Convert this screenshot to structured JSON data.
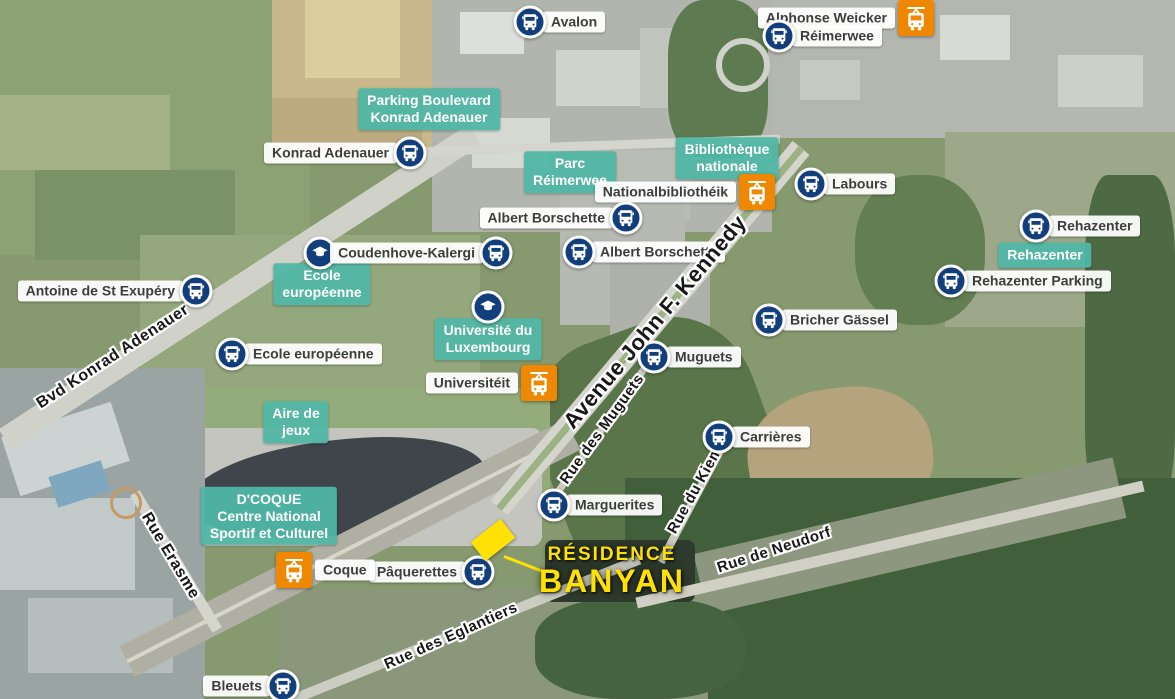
{
  "colors": {
    "bus_blue": "#123f7c",
    "tram_orange": "#ef8800",
    "area_teal": "#50b7a6",
    "stop_label_bg": "#ffffff",
    "stop_label_text": "#3d3d3d",
    "street_text": "#171717",
    "residence_yellow": "#ffe103"
  },
  "markers": [
    {
      "id": "avalon",
      "type": "bus",
      "label": "Avalon",
      "side": "right",
      "x": 530,
      "y": 22
    },
    {
      "id": "alphonse-weicker",
      "type": "tram",
      "label": "Alphonse Weicker",
      "side": "left",
      "x": 916,
      "y": 18
    },
    {
      "id": "reimerwee",
      "type": "bus",
      "label": "Réimerwee",
      "side": "right",
      "x": 779,
      "y": 36
    },
    {
      "id": "konrad-adenauer",
      "type": "bus",
      "label": "Konrad Adenauer",
      "side": "left",
      "x": 410,
      "y": 153
    },
    {
      "id": "nationalbibliotheik",
      "type": "tram",
      "label": "Nationalbibliothéik",
      "side": "left",
      "x": 757,
      "y": 192
    },
    {
      "id": "labours",
      "type": "bus",
      "label": "Labours",
      "side": "right",
      "x": 811,
      "y": 184
    },
    {
      "id": "albert-borschette-1",
      "type": "bus",
      "label": "Albert Borschette",
      "side": "left",
      "x": 626,
      "y": 218
    },
    {
      "id": "albert-borschette-2",
      "type": "bus",
      "label": "Albert Borschette",
      "side": "right",
      "x": 579,
      "y": 252
    },
    {
      "id": "rehazenter",
      "type": "bus",
      "label": "Rehazenter",
      "side": "right",
      "x": 1036,
      "y": 226
    },
    {
      "id": "rehazenter-parking",
      "type": "bus",
      "label": "Rehazenter Parking",
      "side": "right",
      "x": 951,
      "y": 281
    },
    {
      "id": "antoine-de-st-exupery",
      "type": "bus",
      "label": "Antoine de St Exupéry",
      "side": "left",
      "x": 196,
      "y": 291
    },
    {
      "id": "ecole-europeenne-school",
      "type": "school",
      "label": "",
      "side": "none",
      "x": 320,
      "y": 253
    },
    {
      "id": "coudenhove-kalergi",
      "type": "bus",
      "label": "Coudenhove-Kalergi",
      "side": "left",
      "x": 496,
      "y": 253
    },
    {
      "id": "universite-school",
      "type": "school",
      "label": "",
      "side": "none",
      "x": 488,
      "y": 307
    },
    {
      "id": "ecole-europeenne",
      "type": "bus",
      "label": "Ecole européenne",
      "side": "right",
      "x": 232,
      "y": 354
    },
    {
      "id": "bricher-gassel",
      "type": "bus",
      "label": "Bricher Gässel",
      "side": "right",
      "x": 769,
      "y": 320
    },
    {
      "id": "muguets",
      "type": "bus",
      "label": "Muguets",
      "side": "right",
      "x": 654,
      "y": 357
    },
    {
      "id": "universiteit",
      "type": "tram",
      "label": "Universitéit",
      "side": "left",
      "x": 539,
      "y": 383
    },
    {
      "id": "carrieres",
      "type": "bus",
      "label": "Carrières",
      "side": "right",
      "x": 719,
      "y": 437
    },
    {
      "id": "marguerites",
      "type": "bus",
      "label": "Marguerites",
      "side": "right",
      "x": 554,
      "y": 505
    },
    {
      "id": "paquerettes",
      "type": "bus",
      "label": "Pâquerettes",
      "side": "left",
      "x": 478,
      "y": 572
    },
    {
      "id": "coque",
      "type": "tram",
      "label": "Coque",
      "side": "right",
      "x": 294,
      "y": 570
    },
    {
      "id": "bleuets",
      "type": "bus",
      "label": "Bleuets",
      "side": "left",
      "x": 283,
      "y": 686
    }
  ],
  "area_labels": [
    {
      "id": "parking-boulevard-konrad-adenauer",
      "lines": [
        "Parking Boulevard",
        "Konrad Adenauer"
      ],
      "x": 429,
      "y": 109
    },
    {
      "id": "parc-reimerwee",
      "lines": [
        "Parc",
        "Réimerwee"
      ],
      "x": 570,
      "y": 172
    },
    {
      "id": "bibliotheque-nationale",
      "lines": [
        "Bibliothèque",
        "nationale"
      ],
      "x": 727,
      "y": 158
    },
    {
      "id": "rehazenter-area",
      "lines": [
        "Rehazenter"
      ],
      "x": 1045,
      "y": 255
    },
    {
      "id": "ecole-europeenne-area",
      "lines": [
        "Ecole",
        "européenne"
      ],
      "x": 322,
      "y": 284
    },
    {
      "id": "universite-du-luxembourg",
      "lines": [
        "Université du",
        "Luxembourg"
      ],
      "x": 488,
      "y": 339
    },
    {
      "id": "aire-de-jeux",
      "lines": [
        "Aire de",
        "jeux"
      ],
      "x": 296,
      "y": 422
    },
    {
      "id": "dcoque",
      "lines": [
        "D'COQUE",
        "Centre National",
        "Sportif et Culturel"
      ],
      "x": 269,
      "y": 516
    }
  ],
  "street_labels": [
    {
      "id": "avenue-john-f-kennedy",
      "text": "Avenue John F. Kennedy",
      "x": 655,
      "y": 322,
      "rotate": -50,
      "size": 22,
      "top": true
    },
    {
      "id": "bvd-konrad-adenauer",
      "text": "Bvd Konrad Adenauer",
      "x": 113,
      "y": 357,
      "rotate": -33,
      "size": 16,
      "top": false
    },
    {
      "id": "rue-erasme",
      "text": "Rue Erasme",
      "x": 170,
      "y": 556,
      "rotate": 59,
      "size": 16,
      "top": false
    },
    {
      "id": "rue-des-muguets",
      "text": "Rue des Muguets",
      "x": 602,
      "y": 429,
      "rotate": -54,
      "size": 15,
      "top": false
    },
    {
      "id": "rue-du-kiem",
      "text": "Rue du Kiem",
      "x": 695,
      "y": 490,
      "rotate": -61,
      "size": 15,
      "top": false
    },
    {
      "id": "rue-de-neudorf",
      "text": "Rue de Neudorf",
      "x": 774,
      "y": 550,
      "rotate": -18,
      "size": 15,
      "top": false
    },
    {
      "id": "rue-des-eglantiers",
      "text": "Rue des Eglantiers",
      "x": 451,
      "y": 636,
      "rotate": -24,
      "size": 15,
      "top": false
    }
  ],
  "residence": {
    "line1": "RÉSIDENCE",
    "line2": "BANYAN"
  }
}
